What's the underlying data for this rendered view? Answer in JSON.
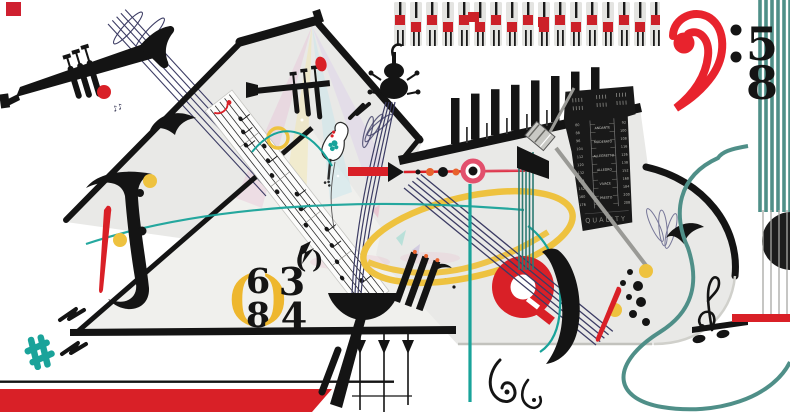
{
  "artwork": {
    "type": "abstract-music-collage-illustration",
    "background": "#ffffff",
    "palette": {
      "red": "#d92027",
      "pink": "#e2506d",
      "orange": "#e8622d",
      "yellow": "#eec23f",
      "gold_paren": "#eeb72e",
      "teal": "#19a39a",
      "muted_teal": "#4f8f88",
      "navy": "#3c3c64",
      "gray_body": "#e9e9e7",
      "black": "#141414"
    },
    "time_signature_58": {
      "numerator": "5",
      "denominator": "8"
    },
    "time_signature_68": {
      "open_paren": "(",
      "numerator": "6",
      "denominator": "8",
      "close_paren": ")"
    },
    "time_signature_34": {
      "numerator": "3",
      "denominator": "4"
    },
    "grace_note": {
      "open_paren": "(",
      "close_paren": ")"
    },
    "note_glyphs": "♪♪",
    "metronome": {
      "brand": "QUALITY",
      "left_numbers": [
        "80",
        "88",
        "96",
        "104",
        "112",
        "120",
        "132",
        "144",
        "152",
        "160",
        "176"
      ],
      "right_numbers": [
        "92",
        "100",
        "108",
        "116",
        "126",
        "138",
        "152",
        "168",
        "184",
        "200",
        "208"
      ],
      "tempo_words": [
        "ANDANTE",
        "MODERATO",
        "ALLEGRETTO",
        "ALLEGRO",
        "VIVACE",
        "PRESTO"
      ]
    }
  }
}
